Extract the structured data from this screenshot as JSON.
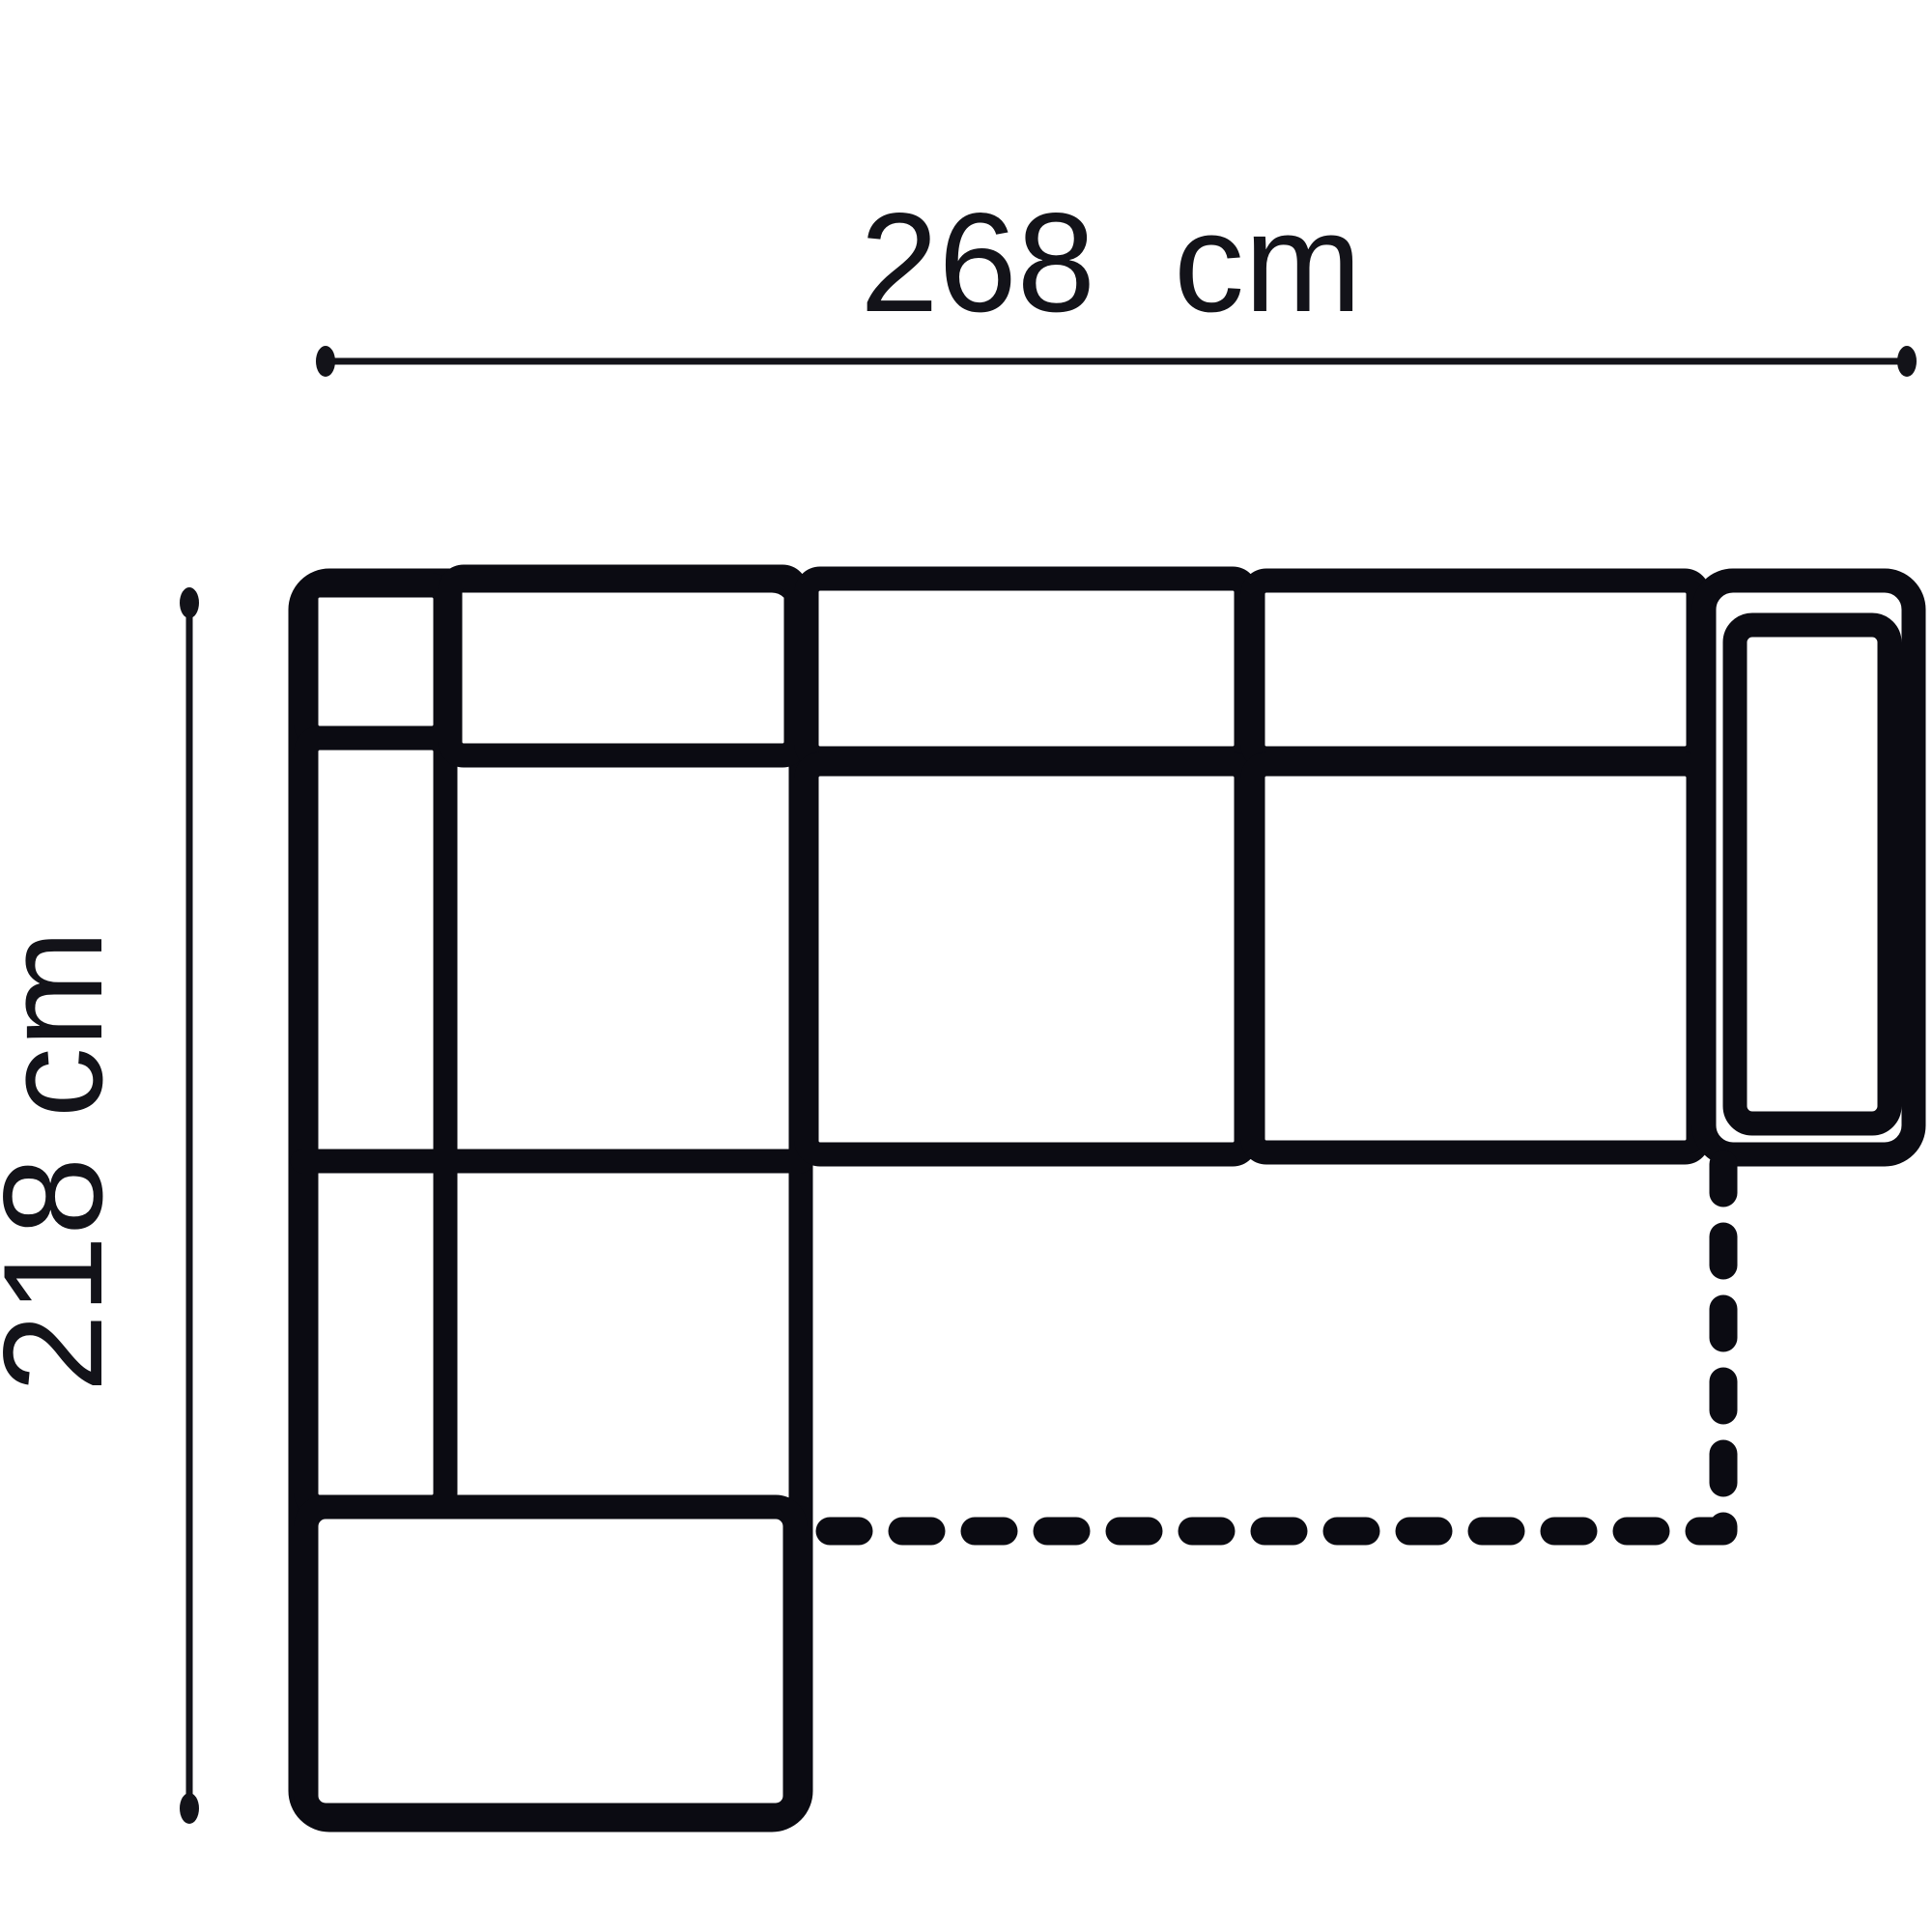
{
  "diagram": {
    "kind": "sofa-floorplan-dimension-drawing",
    "width_label": "268  cm",
    "depth_label": "218 cm",
    "width_cm": 268,
    "depth_cm": 218,
    "colors": {
      "line": "#0b0b12",
      "dimension": "#131319",
      "background": "#ffffff"
    }
  }
}
